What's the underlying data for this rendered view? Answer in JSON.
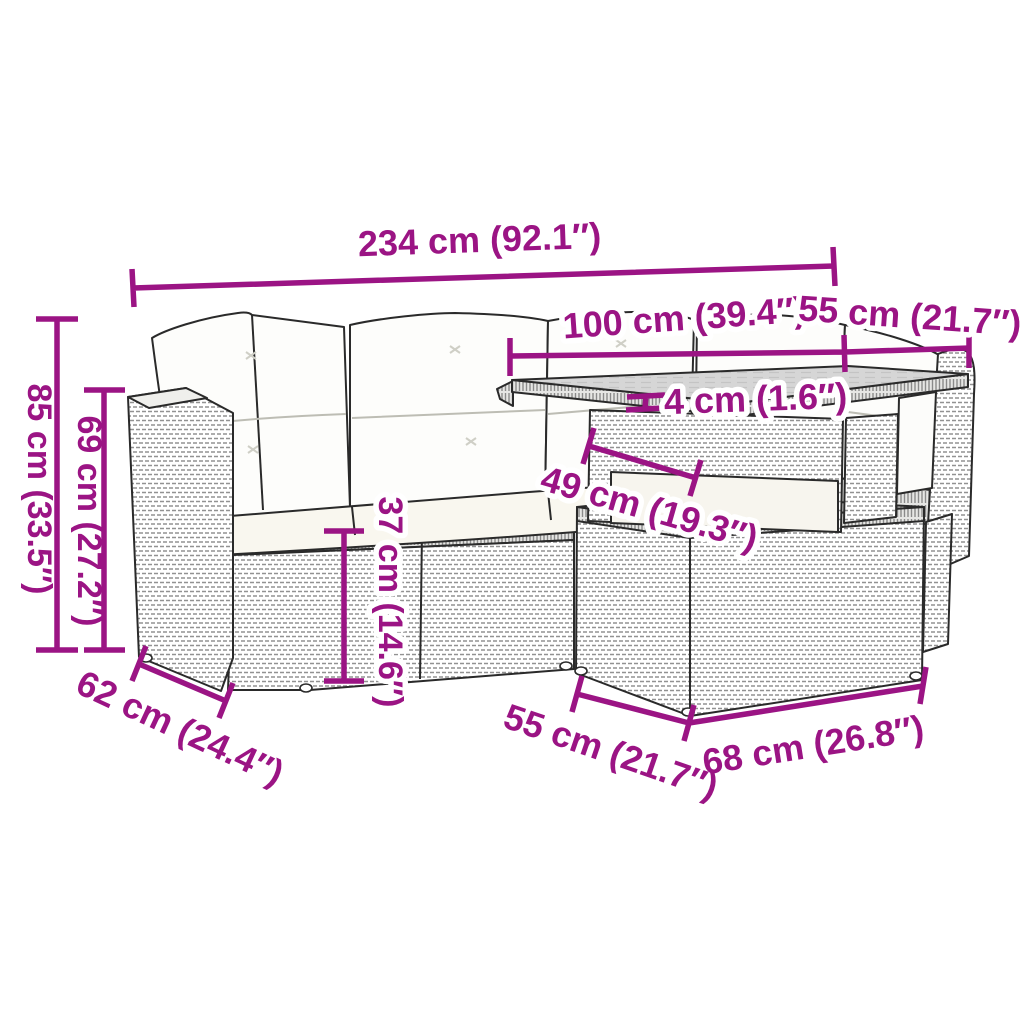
{
  "diagram": {
    "kind": "product-dimension-diagram",
    "product": "rattan garden lounge set with cushions, glass-top table and ottoman",
    "accent_color": "#9B1484",
    "outline_color": "#2a2a2a",
    "cushion_color": "#fdfdfb",
    "glass_color": "#d6d6d6",
    "background_color": "#ffffff"
  },
  "dimensions": {
    "total_width": "234 cm (92.1″)",
    "table_length": "100 cm (39.4″)",
    "table_width_top": "55 cm (21.7″)",
    "glass_thickness": "4 cm (1.6″)",
    "under_table_clearance": "49 cm (19.3″)",
    "seat_height": "37 cm (14.6″)",
    "total_height": "85 cm (33.5″)",
    "back_height": "69 cm (27.2″)",
    "sofa_depth": "62 cm (24.4″)",
    "ottoman_depth": "55 cm (21.7″)",
    "ottoman_width": "68 cm (26.8″)"
  }
}
